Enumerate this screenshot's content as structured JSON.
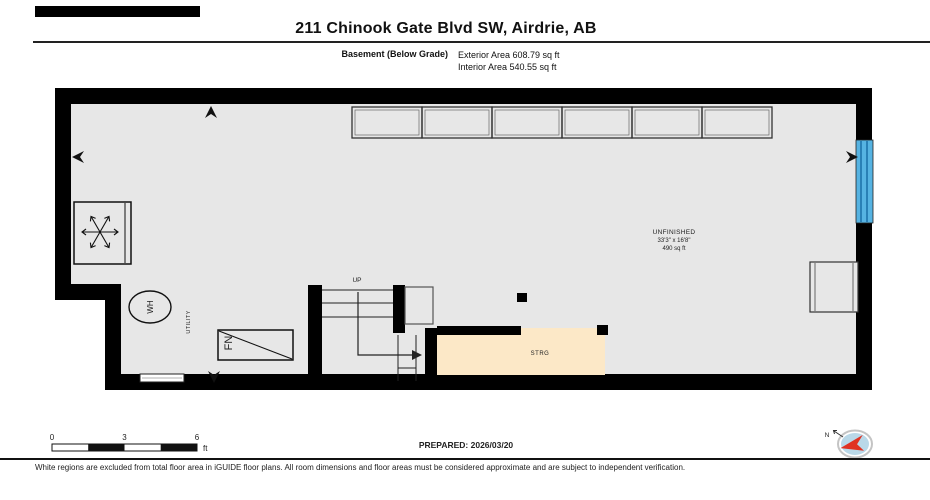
{
  "header": {
    "title": "211 Chinook Gate Blvd SW, Airdrie, AB",
    "floor_label": "Basement (Below Grade)",
    "exterior_area": "Exterior Area 608.79 sq ft",
    "interior_area": "Interior Area 540.55 sq ft"
  },
  "plan": {
    "unfinished": {
      "name": "UNFINISHED",
      "dimensions": "33'3\" x 16'8\"",
      "area": "490 sq ft"
    },
    "storage_label": "STRG",
    "utility_label": "UTILITY",
    "stairs_up_label": "UP",
    "water_heater_label": "WH",
    "furnace_label": "FN"
  },
  "scale_bar": {
    "ticks": [
      "0",
      "3",
      "6"
    ],
    "unit": "ft"
  },
  "prepared": "PREPARED: 2026/03/20",
  "compass": {
    "north_label": "N"
  },
  "footer": {
    "disclaimer": "White regions are excluded from total floor area in iGUIDE floor plans. All room dimensions and floor areas must be considered approximate and are subject to independent verification."
  },
  "colors": {
    "wall": "#000000",
    "floor": "#e7e7e7",
    "storage_fill": "#fce8c7",
    "window_blue": "#56b3e2",
    "window_blue_dark": "#1a6fa8",
    "compass_fill": "#b9d8e8",
    "compass_needle": "#e03222"
  }
}
